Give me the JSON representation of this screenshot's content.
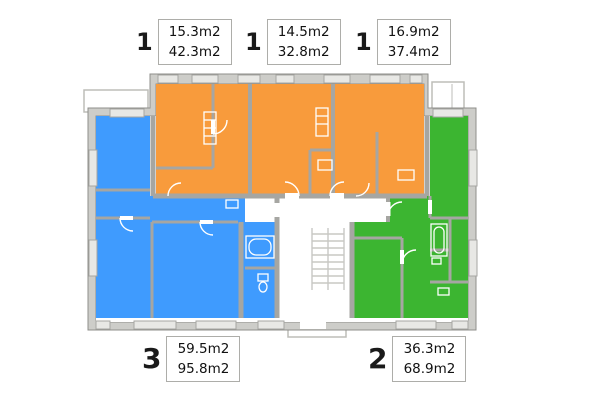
{
  "colors": {
    "one_room": "#F89B3C",
    "three_room": "#3F9BFE",
    "two_room": "#3CB531",
    "wall": "#CDCDC9",
    "wall_stroke": "#8F8F8B",
    "window": "#E8E8E5",
    "stairs": "#C8C8C4"
  },
  "labels": {
    "top": [
      {
        "number": "1",
        "line1": "15.3m2",
        "line2": "42.3m2"
      },
      {
        "number": "1",
        "line1": "14.5m2",
        "line2": "32.8m2"
      },
      {
        "number": "1",
        "line1": "16.9m2",
        "line2": "37.4m2"
      }
    ],
    "bottom": [
      {
        "number": "3",
        "line1": "59.5m2",
        "line2": "95.8m2"
      },
      {
        "number": "2",
        "line1": "36.3m2",
        "line2": "68.9m2"
      }
    ]
  }
}
